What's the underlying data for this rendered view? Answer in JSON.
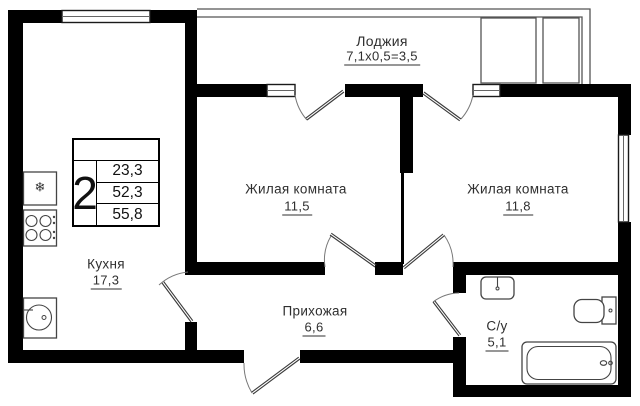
{
  "labels": {
    "loggia": {
      "name": "Лоджия",
      "dims": "7,1х0,5=3,5"
    },
    "room1": {
      "name": "Жилая комната",
      "area": "11,5"
    },
    "room2": {
      "name": "Жилая комната",
      "area": "11,8"
    },
    "kitchen": {
      "name": "Кухня",
      "area": "17,3"
    },
    "hallway": {
      "name": "Прихожая",
      "area": "6,6"
    },
    "bathroom": {
      "name": "С/у",
      "area": "5,1"
    }
  },
  "info_badge": {
    "rooms": "2",
    "values": [
      "23,3",
      "52,3",
      "55,8"
    ]
  },
  "icons": {
    "snowflake": "❄"
  },
  "colors": {
    "wall": "#000000",
    "line": "#555555",
    "text": "#2f2f2f",
    "bg": "#ffffff"
  }
}
